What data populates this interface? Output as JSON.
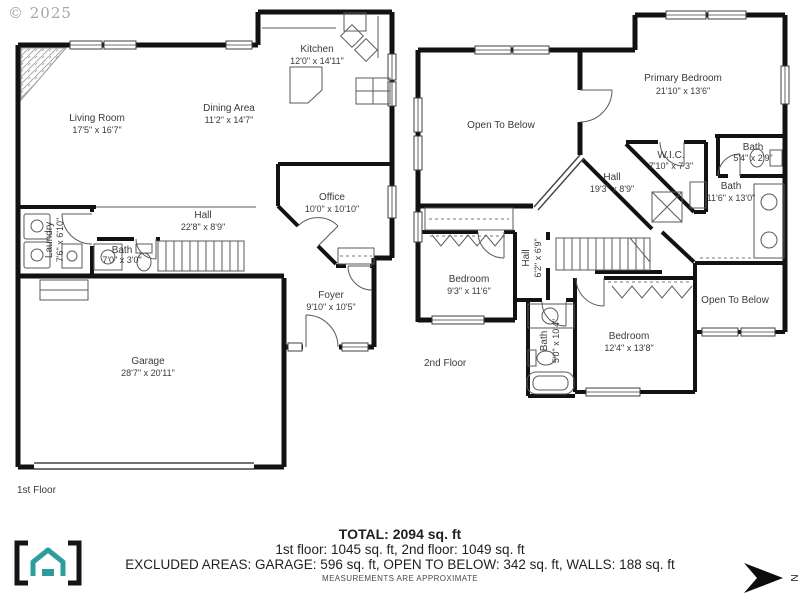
{
  "copyright": "© 2025",
  "f1": {
    "label": "1st Floor",
    "rooms": [
      {
        "name": "Living Room",
        "dims": "17'5\" x 16'7\""
      },
      {
        "name": "Kitchen",
        "dims": "12'0\" x 14'11\""
      },
      {
        "name": "Dining Area",
        "dims": "11'2\" x 14'7\""
      },
      {
        "name": "Office",
        "dims": "10'0\" x 10'10\""
      },
      {
        "name": "Hall",
        "dims": "22'8\" x 8'9\""
      },
      {
        "name": "Laundry",
        "dims": "7'6\" x 6'10\""
      },
      {
        "name": "Bath",
        "dims": "7'0\" x 3'0\""
      },
      {
        "name": "Foyer",
        "dims": "9'10\" x 10'5\""
      },
      {
        "name": "Garage",
        "dims": "28'7\" x 20'11\""
      }
    ]
  },
  "f2": {
    "label": "2nd Floor",
    "rooms": [
      {
        "name": "Open To Below",
        "dims": ""
      },
      {
        "name": "Primary Bedroom",
        "dims": "21'10\" x 13'6\""
      },
      {
        "name": "W.I.C.",
        "dims": "7'10\" x 7'3\""
      },
      {
        "name": "Bath",
        "dims": "5'4\" x 2'9\""
      },
      {
        "name": "Hall",
        "dims": "19'3\" x 8'9\""
      },
      {
        "name": "Bath",
        "dims": "11'6\" x 13'0\""
      },
      {
        "name": "Bedroom",
        "dims": "9'3\" x 11'6\""
      },
      {
        "name": "Hall",
        "dims": "6'2\" x 6'9\""
      },
      {
        "name": "Bath",
        "dims": "5'0\" x 10'4\""
      },
      {
        "name": "Bedroom",
        "dims": "12'4\" x 13'8\""
      },
      {
        "name": "Open To Below",
        "dims": ""
      }
    ]
  },
  "footer": {
    "total": "TOTAL: 2094 sq. ft",
    "floors": "1st floor: 1045 sq. ft, 2nd floor: 1049 sq. ft",
    "excluded": "EXCLUDED AREAS: GARAGE: 596 sq. ft, OPEN TO BELOW: 342 sq. ft, WALLS: 188 sq. ft",
    "disclaimer": "MEASUREMENTS ARE APPROXIMATE"
  },
  "compass": {
    "label": "N"
  },
  "colors": {
    "brand_teal": "#2d9da0",
    "wall": "#111111"
  }
}
